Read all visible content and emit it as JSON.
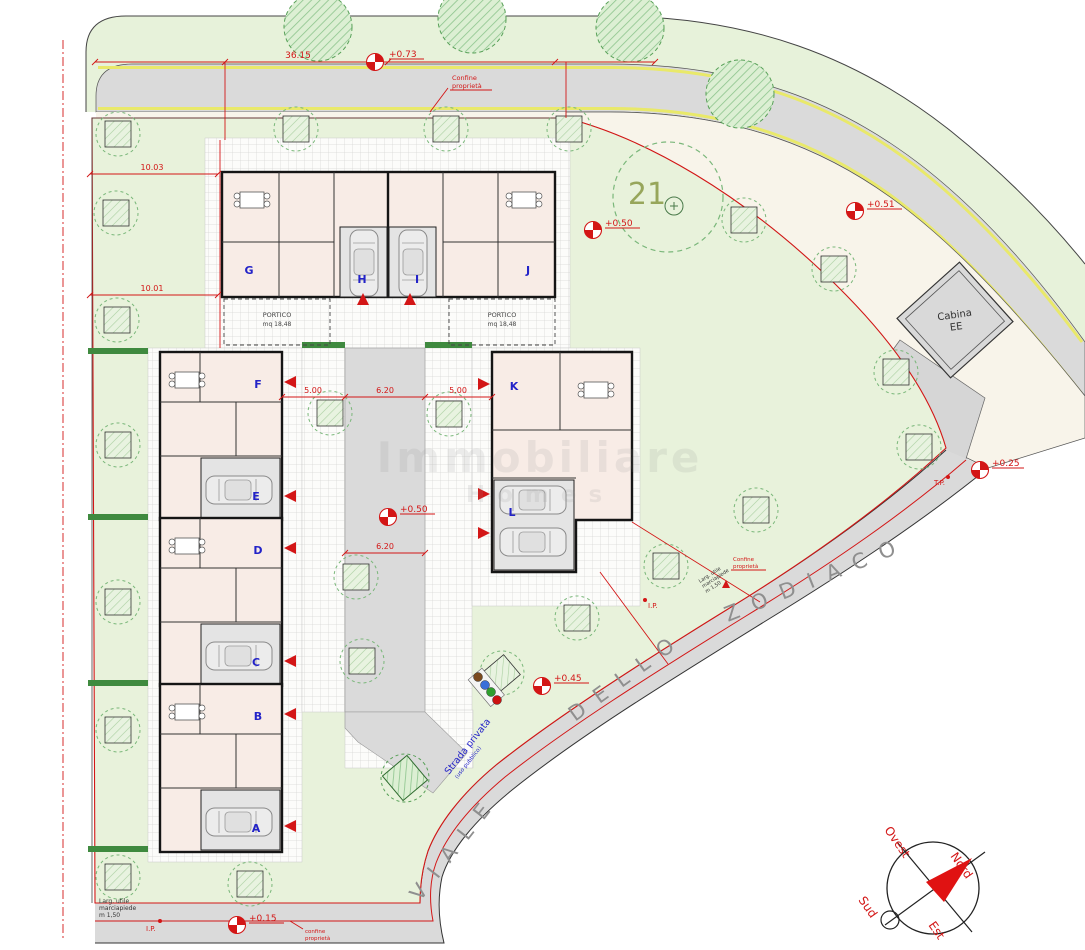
{
  "units": {
    "a": "A",
    "b": "B",
    "c": "C",
    "d": "D",
    "e": "E",
    "f": "F",
    "g": "G",
    "h": "H",
    "i": "I",
    "j": "J",
    "k": "K",
    "l": "L"
  },
  "elevations": {
    "e073": "+0.73",
    "e051": "+0.51",
    "e050a": "+0.50",
    "e050b": "+0.50",
    "e045": "+0.45",
    "e025": "+0.25",
    "e015": "+0.15"
  },
  "dims": {
    "d3615": "36.15",
    "d1003": "10.03",
    "d1001": "10.01",
    "d500a": "5.00",
    "d620a": "6.20",
    "d500b": "5.00",
    "d620b": "6.20"
  },
  "street": {
    "w1": "VIALE",
    "w2": "DELLO",
    "w3": "ZODIACO"
  },
  "labels": {
    "cabina1": "Cabina",
    "cabina2": "EE",
    "tree21": "21",
    "confine1": "Confine",
    "confine2": "proprietà",
    "confb1": "confine",
    "confb2": "proprietà",
    "ip": "I.P.",
    "tp": "T.P.",
    "strada1": "Strada privata",
    "strada2": "(uso pubblico)",
    "portico1": "PORTICO",
    "portico2": "mq 18,48",
    "side1": "Larg. utile",
    "side2": "marciapiede",
    "side3": "m 1,50"
  },
  "compass": {
    "n": "Nord",
    "s": "Sud",
    "e": "Est",
    "o": "Ovest"
  },
  "watermark": {
    "l1": "Immobiliare",
    "l2": "Homes"
  },
  "colors": {
    "lawn": "#e8f2db",
    "road": "#dadada",
    "dim_red": "#d31616",
    "unit_blue": "#2323c8",
    "street_gray": "#8f8f8f",
    "tree_green": "#7ab77a",
    "yellow_line": "#e9e96a"
  }
}
